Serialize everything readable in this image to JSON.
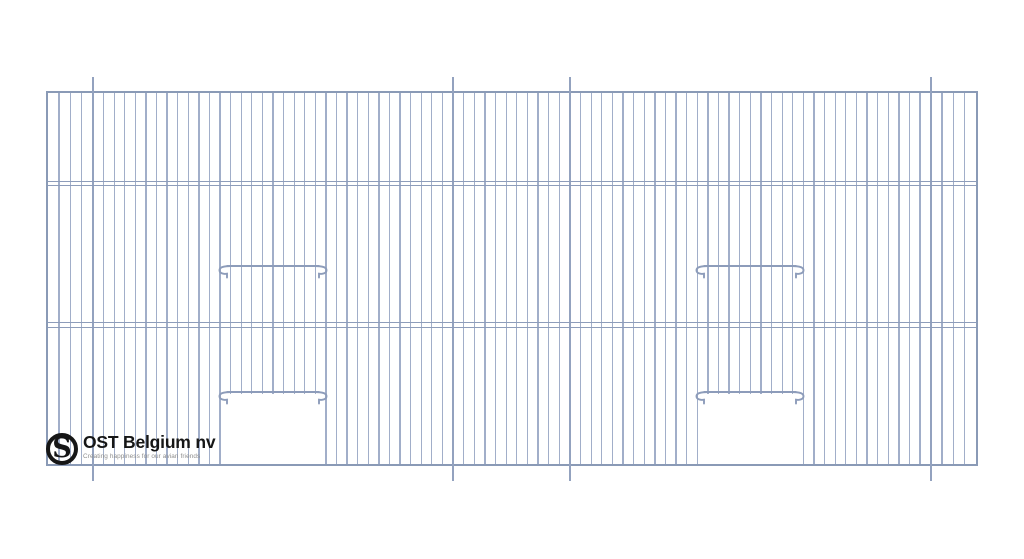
{
  "title": "Cage front technical drawing",
  "logo": {
    "monogram": "S",
    "company": "OST Belgium nv",
    "tagline": "Creating happiness for our avian friends"
  },
  "drawing": {
    "colors": {
      "wire": "#a1aec9",
      "seam": "#93a2bf",
      "frame": "#8a9ab6",
      "accent": "#8d9cba",
      "ink": "#161616",
      "gray": "#8e8e8e"
    },
    "panel": {
      "left": 45.5,
      "top": 90.5,
      "right": 978,
      "bottom": 466,
      "border_px": 2
    },
    "inner": {
      "left": 47.5,
      "top": 92.5,
      "right": 976,
      "bottom": 464
    },
    "sections": [
      {
        "x0": 47.5,
        "x1": 93,
        "gaps": 4
      },
      {
        "x0": 93,
        "x1": 453,
        "gaps": 34
      },
      {
        "x0": 453,
        "x1": 570,
        "gaps": 11
      },
      {
        "x0": 570,
        "x1": 930.7,
        "gaps": 34
      },
      {
        "x0": 930.7,
        "x1": 976,
        "gaps": 4
      }
    ],
    "seams": {
      "xs": [
        93,
        453,
        570,
        930.7
      ],
      "y0": 76.5,
      "y1": 480.5
    },
    "dividers": {
      "ys": [
        180.8,
        322.3
      ]
    },
    "openings": [
      {
        "x0": 221,
        "x1": 324.5,
        "wire_stop_y": 393.5
      },
      {
        "x0": 698.5,
        "x1": 802,
        "wire_stop_y": 393.5
      }
    ],
    "doors": [
      {
        "cx": 272.9,
        "bar_width": 118,
        "top_bar_y": 262,
        "bottom_bar_y": 388
      },
      {
        "cx": 750.3,
        "bar_width": 118,
        "top_bar_y": 262,
        "bottom_bar_y": 388
      }
    ]
  }
}
